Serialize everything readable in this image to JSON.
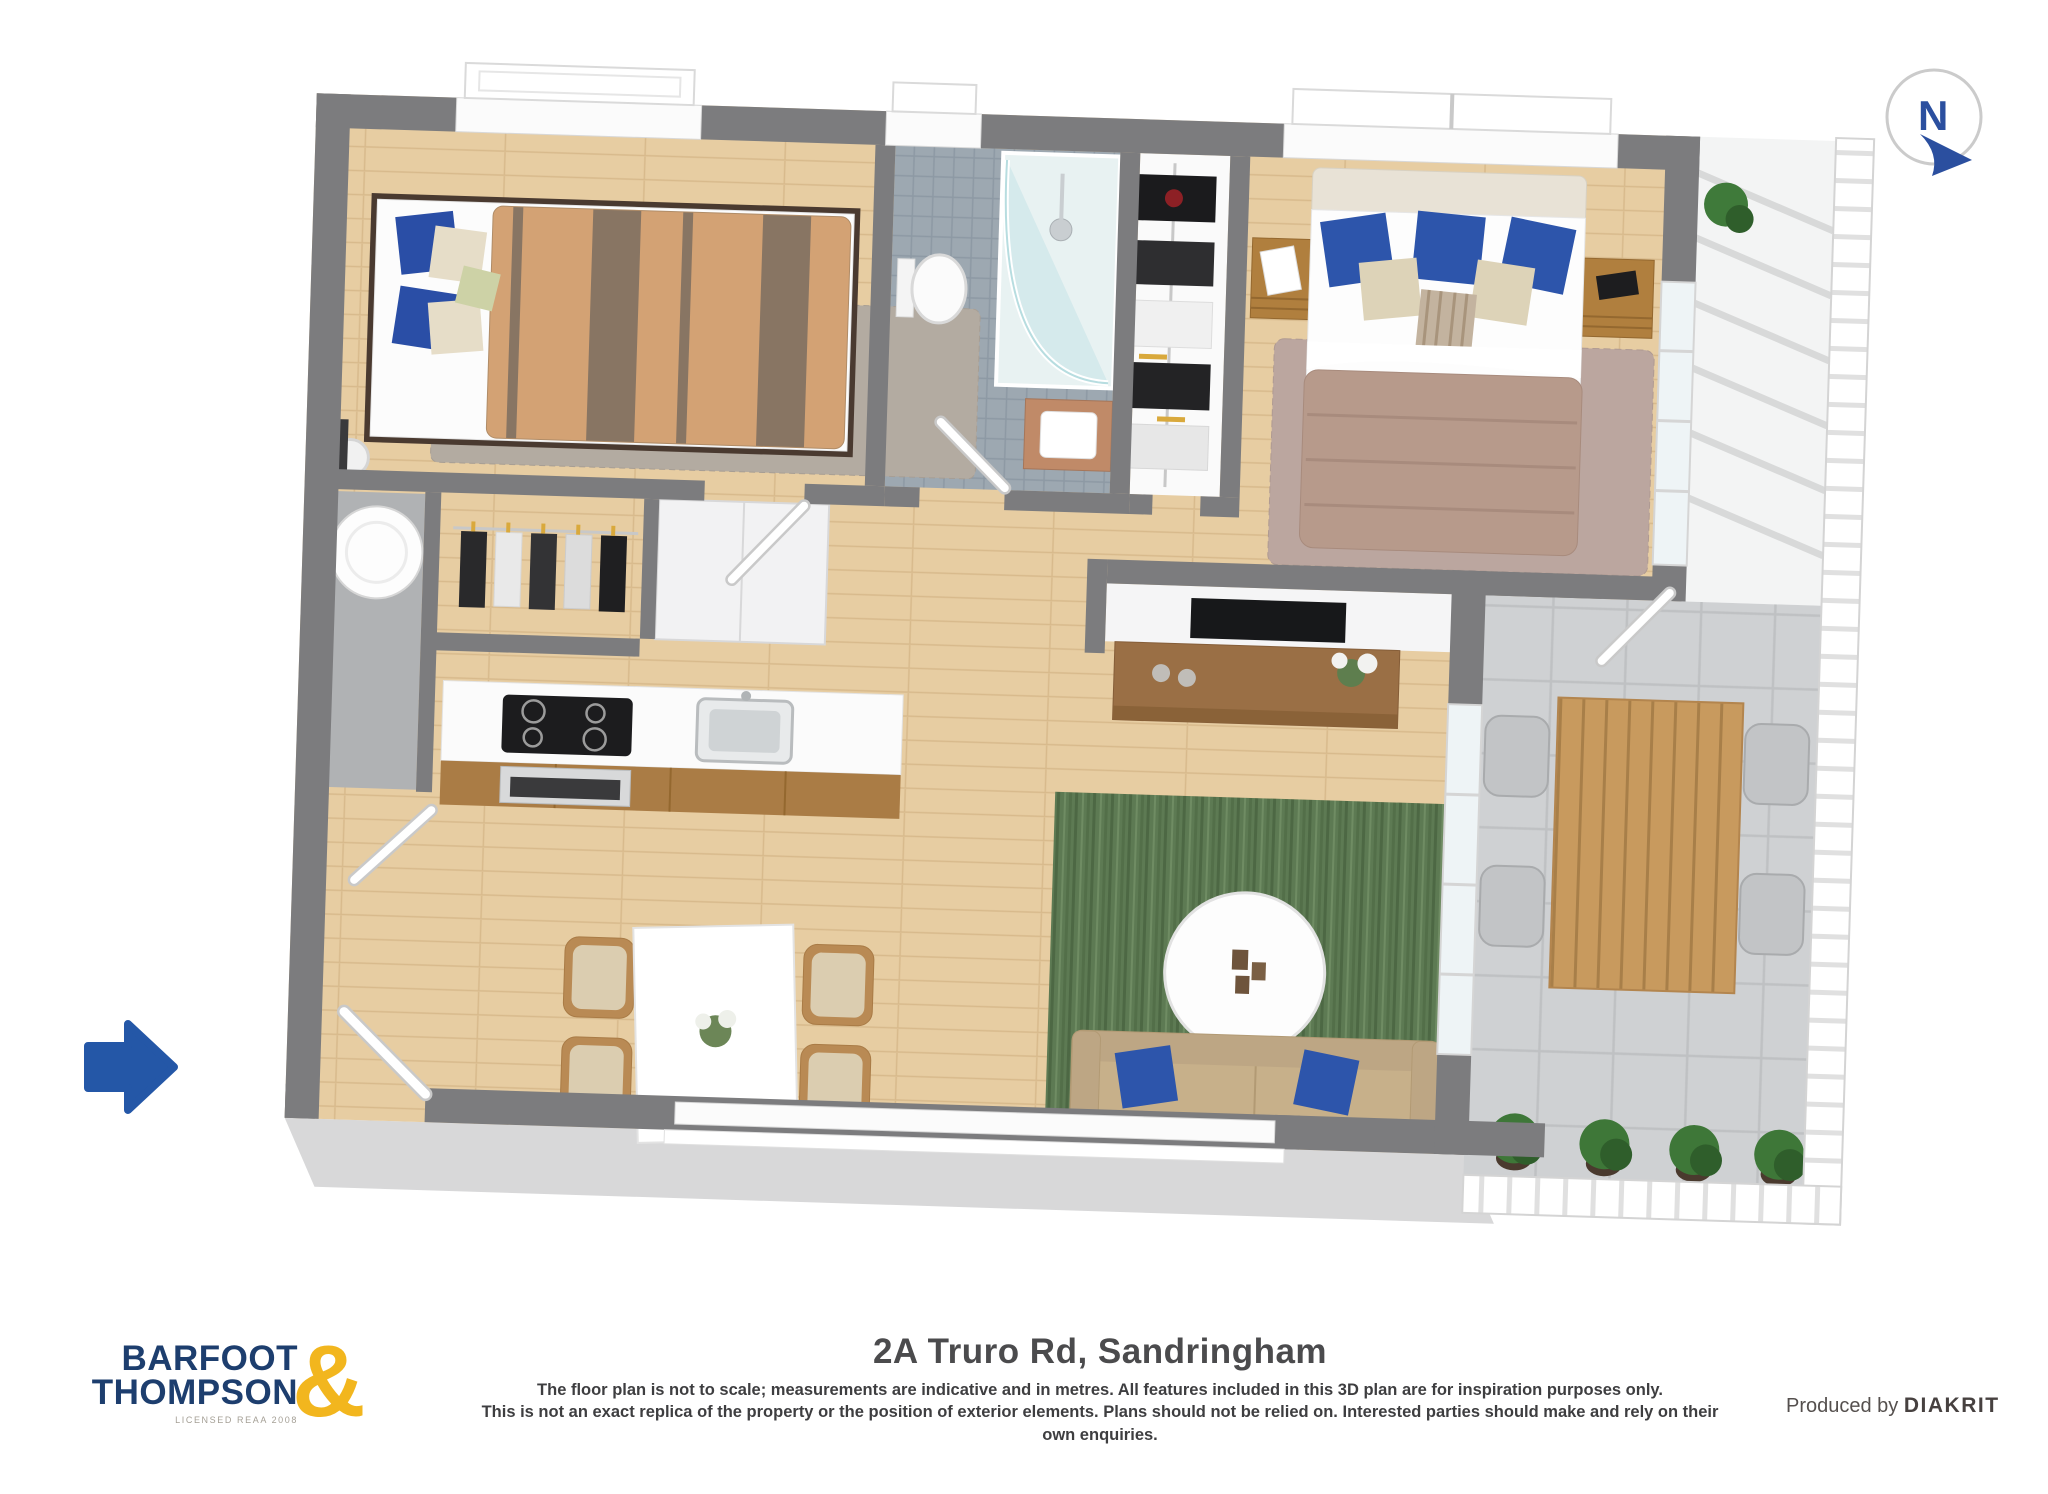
{
  "title": "2A Truro Rd, Sandringham",
  "footer": {
    "logo": {
      "line1": "BARFOOT",
      "line2": "THOMPSON",
      "ampersand": "&",
      "license": "LICENSED REAA 2008"
    },
    "disclaimer_line1": "The floor plan is not to scale; measurements are indicative and in metres. All features included in this 3D plan are for inspiration purposes only.",
    "disclaimer_line2": "This is not an exact replica of the property or the position of exterior elements. Plans should not be relied on. Interested parties should make and rely on their own enquiries.",
    "producer_prefix": "Produced by",
    "producer_name": "DIAKRIT"
  },
  "compass": {
    "label": "N"
  },
  "colors": {
    "brand_navy": "#1d3e6e",
    "brand_gold": "#f2b61e",
    "arrow_blue": "#2457a7",
    "compass_blue": "#2b4f9f",
    "wall_gray": "#7c7c7e",
    "facade_gray": "#d8d8d9",
    "floor_wood": "#e7cda2",
    "bath_tile": "#9da8b1",
    "terrace_tile": "#cfd1d3",
    "rug_green": "#5d7a53",
    "rug_gray": "#b3aba1",
    "rug_mauve": "#bba69f",
    "duvet_master": "#b79a8b",
    "duvet_tan": "#d3a274",
    "duvet_brown": "#887563",
    "pillow_blue": "#2d55ab",
    "sofa_beige": "#c7b08a",
    "wood_furniture": "#b07f3e",
    "title_text": "#4b4b4d"
  }
}
